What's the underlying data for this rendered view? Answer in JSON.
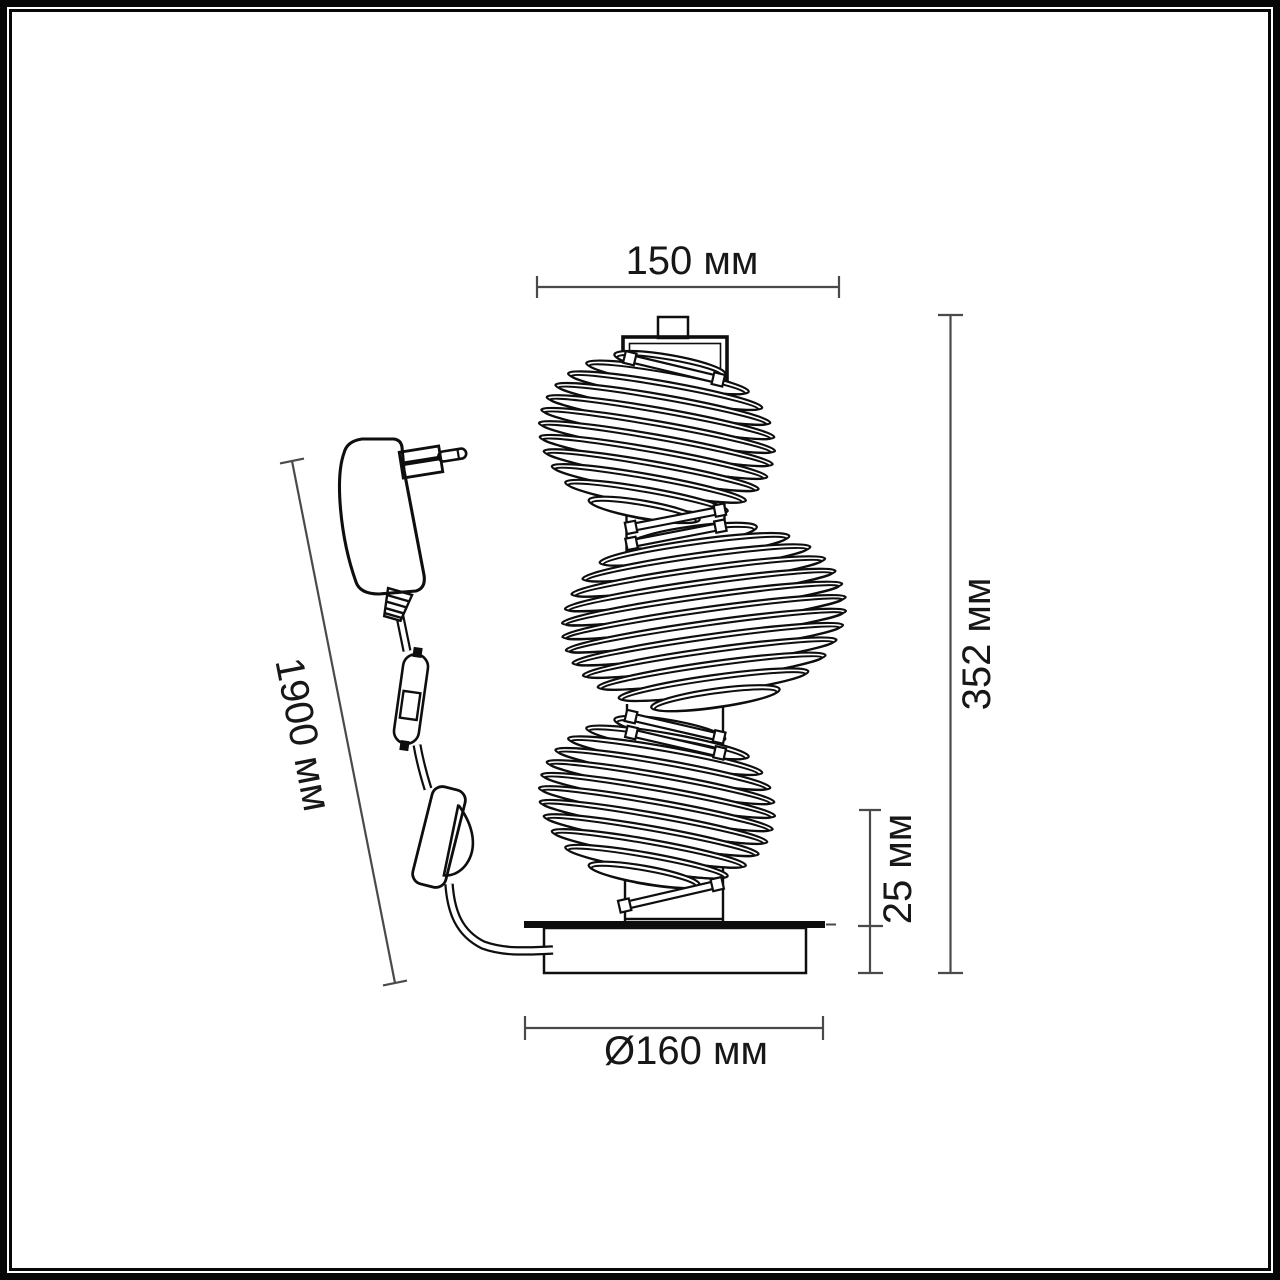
{
  "diagram": {
    "type": "product-dimension-drawing",
    "subject": "table lamp with three ribbed shades, power adapter, inline switch and round base",
    "dimensions": {
      "top_width": "150 мм",
      "total_height": "352 мм",
      "base_plate_height": "25 мм",
      "cord_length": "1900 мм",
      "base_diameter": "Ø160 мм"
    },
    "colors": {
      "outline": "#0e0e0e",
      "dimension_line": "#4a4a4a",
      "label_text": "#171717",
      "frame": "#070707",
      "background": "#ffffff"
    }
  }
}
